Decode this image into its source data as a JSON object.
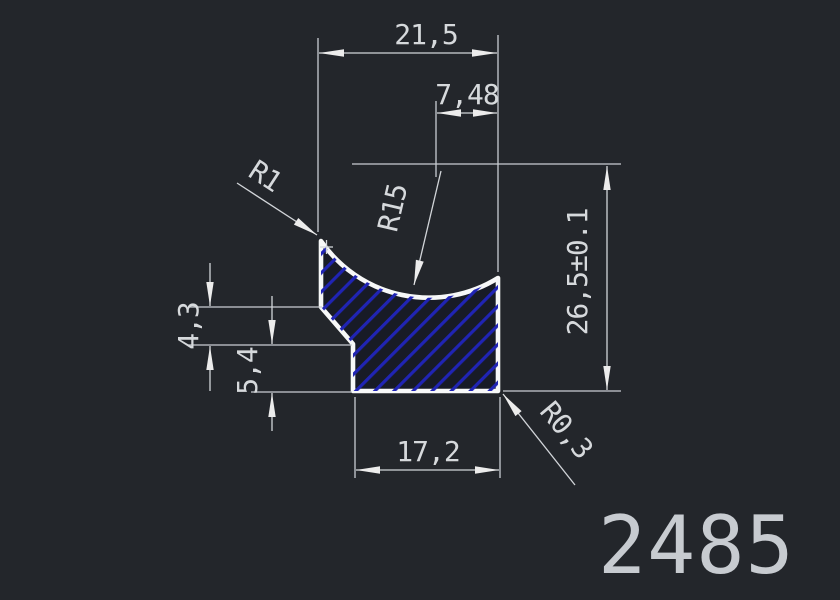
{
  "drawing": {
    "part_number": "2485",
    "dimensions": {
      "top_width": "21,5",
      "arc_center_offset": "7,48",
      "total_height": "26,5±0.1",
      "chamfer_height": "4,3",
      "base_height": "5,4",
      "bottom_width": "17,2",
      "corner_radius": "R1",
      "cove_radius": "R15",
      "fillet_radius": "R0,3"
    },
    "colors": {
      "background": "#23262b",
      "profile_outline": "#f7f8f8",
      "profile_fill": "#181b26",
      "hatch_blue": "#2024b4",
      "dimension_lines": "#d2d5d9",
      "dimension_text": "#d6d9dc",
      "part_number_text": "#c7cbd0"
    }
  }
}
